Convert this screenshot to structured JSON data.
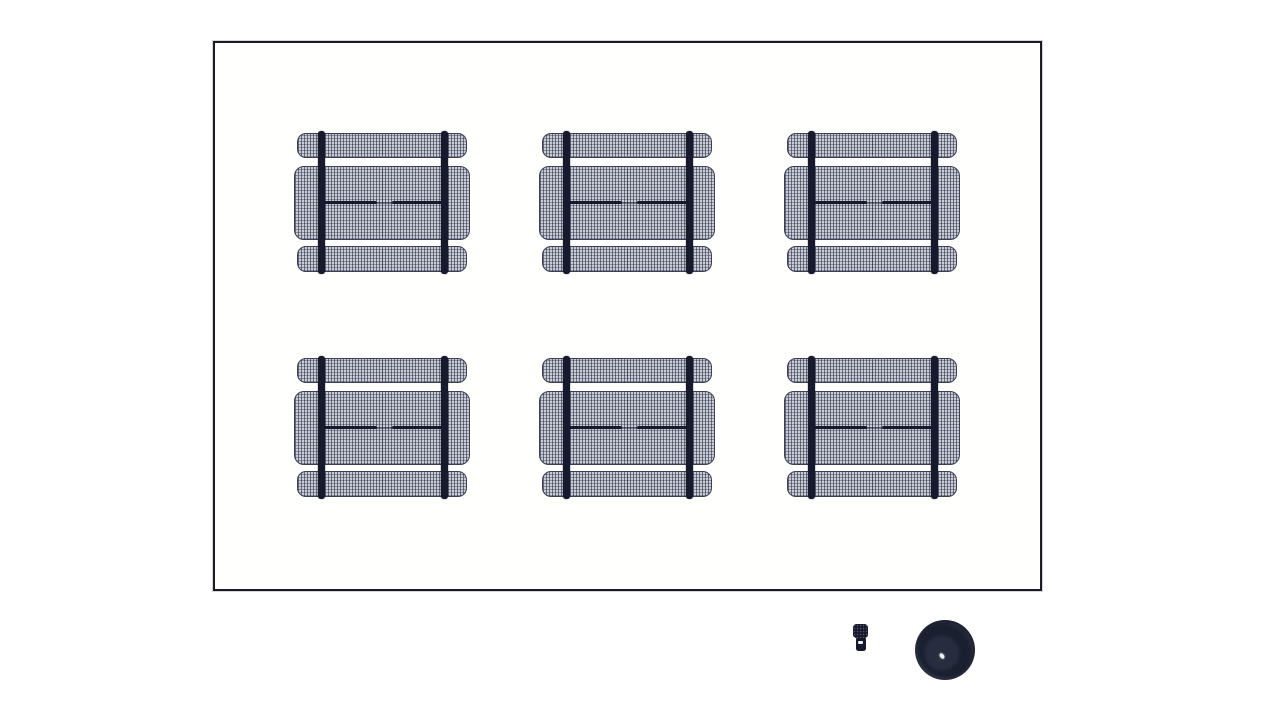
{
  "scene": {
    "description": "Top-down site plan: six mesh picnic tables in a 2x3 grid inside a rectangular boundary; a pedestal grill and a round trash can sit outside the boundary at the lower right",
    "boundary": {
      "x": 213,
      "y": 41,
      "width": 829,
      "height": 550
    },
    "tables": [
      {
        "id": "picnic-table-r1c1",
        "row": 1,
        "col": 1,
        "cx": 382,
        "cy": 202
      },
      {
        "id": "picnic-table-r1c2",
        "row": 1,
        "col": 2,
        "cx": 627,
        "cy": 202
      },
      {
        "id": "picnic-table-r1c3",
        "row": 1,
        "col": 3,
        "cx": 872,
        "cy": 202
      },
      {
        "id": "picnic-table-r2c1",
        "row": 2,
        "col": 1,
        "cx": 382,
        "cy": 427
      },
      {
        "id": "picnic-table-r2c2",
        "row": 2,
        "col": 2,
        "cx": 627,
        "cy": 427
      },
      {
        "id": "picnic-table-r2c3",
        "row": 2,
        "col": 3,
        "cx": 872,
        "cy": 427
      }
    ],
    "table_count": 6,
    "grill": {
      "x": 853,
      "y": 624,
      "width": 15,
      "height": 27
    },
    "trash_can": {
      "cx": 945,
      "cy": 650,
      "radius": 30
    }
  },
  "colors": {
    "background": "#ffffff",
    "boundary_border": "#1b1b24",
    "mesh_base": "#c9ccd4",
    "mesh_weave": "#232840",
    "frame_dark": "#161a2c",
    "trash_outer": "#2e3447",
    "trash_inner": "#1b2031",
    "highlight": "#eceef2"
  }
}
